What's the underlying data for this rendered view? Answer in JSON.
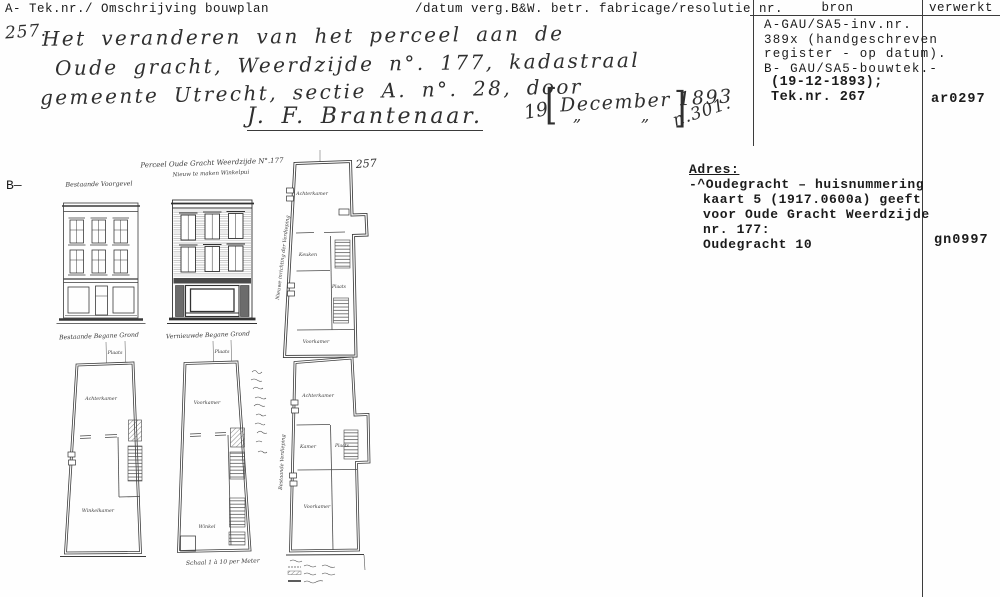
{
  "header": {
    "left": "A- Tek.nr./ Omschrijving bouwplan",
    "middle": "/datum verg.B&W. betr. fabricage/resolutie nr.",
    "col_bron": "bron",
    "col_verwerkt": "verwerkt"
  },
  "handwriting": {
    "number": "257.",
    "line1": "Het veranderen van het perceel aan de",
    "line2": "Oude gracht, Weerdzijde n°. 177, kadastraal",
    "line3": "gemeente Utrecht, sectie A. n°. 28, door",
    "signature": "J. F. Brantenaar.",
    "day": "19",
    "bracket_open": "[",
    "date_insert": "December 1893",
    "bracket_close": "]",
    "ditto1": "„",
    "ditto2": "„",
    "resolution": "n.301."
  },
  "bron": {
    "lines": [
      "A-GAU/SA5-inv.nr.",
      "389x (handgeschreven",
      "register - op datum).",
      "B- GAU/SA5-bouwtek.-",
      "(19-12-1893);",
      "Tek.nr. 267"
    ]
  },
  "verwerkt": {
    "entry_a": "ar0297",
    "entry_b": "gn0997"
  },
  "adres": {
    "heading": "Adres:",
    "lines": [
      "-^Oudegracht – huisnummering",
      "kaart 5 (1917.0600a) geeft",
      "voor Oude Gracht Weerdzijde",
      "nr. 177:",
      "Oudegracht 10"
    ]
  },
  "margin_label": "B—",
  "drawing": {
    "sheet_number": "257",
    "title": "Perceel Oude Gracht Weerdzijde N°.177",
    "subtitle": "Nieuw te maken Winkelpui",
    "caption_facade_left": "Bestaande Voorgevel",
    "caption_plan_left": "Bestaande Begane Grond",
    "caption_plan_mid": "Vernieuwde Begane Grond",
    "label_plaats_left": "Plaats",
    "label_plaats_mid": "Plaats",
    "label_vertical_top_plan": "Nieuwe inrichting der Verdieping",
    "label_vertical_bottom_plan": "Bestaande Verdieping",
    "scale_note": "Schaal 1 à 10 per Meter",
    "rooms_top_plan": [
      "Achterkamer",
      "Keuken",
      "Plaats",
      "Voorkamer"
    ],
    "rooms_plan_left": [
      "Achterkamer",
      "Winkelkamer"
    ],
    "rooms_plan_mid": [
      "Voorkamer",
      "Winkel"
    ],
    "rooms_plan_right": [
      "Achterkamer",
      "Kamer",
      "Plaats",
      "Voorkamer"
    ]
  }
}
